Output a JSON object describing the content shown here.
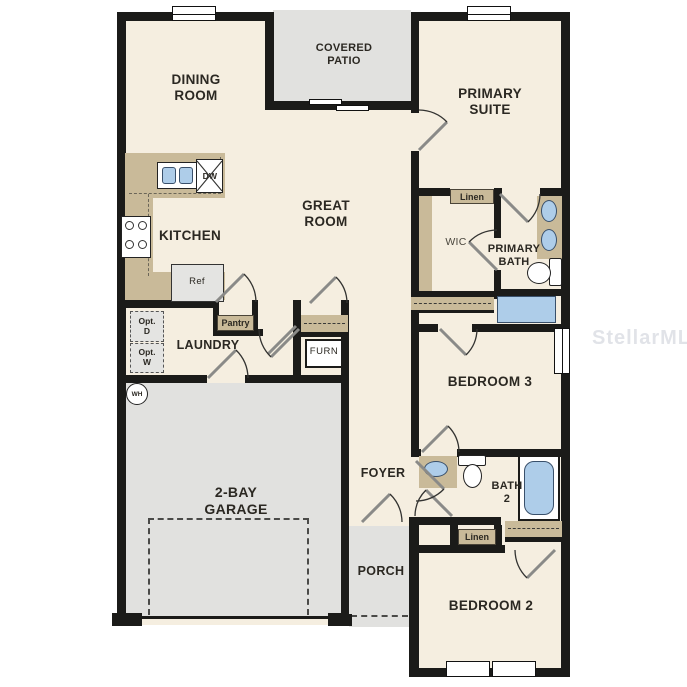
{
  "watermark": "StellarMLS",
  "rooms": {
    "dining": "DINING\nROOM",
    "covered_patio": "COVERED\nPATIO",
    "primary_suite": "PRIMARY\nSUITE",
    "great_room": "GREAT\nROOM",
    "kitchen": "KITCHEN",
    "wic": "WIC",
    "primary_bath": "PRIMARY\nBATH",
    "laundry": "LAUNDRY",
    "bedroom3": "BEDROOM 3",
    "garage": "2-BAY\nGARAGE",
    "foyer": "FOYER",
    "bath2": "BATH\n2",
    "porch": "PORCH",
    "bedroom2": "BEDROOM 2"
  },
  "fixtures": {
    "dishwasher": "DW",
    "refrigerator": "Ref",
    "pantry": "Pantry",
    "furnace": "FURN",
    "opt_dryer": "Opt.\nD",
    "opt_washer": "Opt.\nW",
    "water_heater": "WH",
    "linen_primary": "Linen",
    "linen_hall": "Linen"
  },
  "colors": {
    "floor": "#f5eee0",
    "outdoor": "#e1e1df",
    "wall": "#1b1b19",
    "cabinet": "#c9ba99",
    "fixture_blue": "#aecde9",
    "label": "#2b2822",
    "watermark": "#c9cdd6"
  }
}
